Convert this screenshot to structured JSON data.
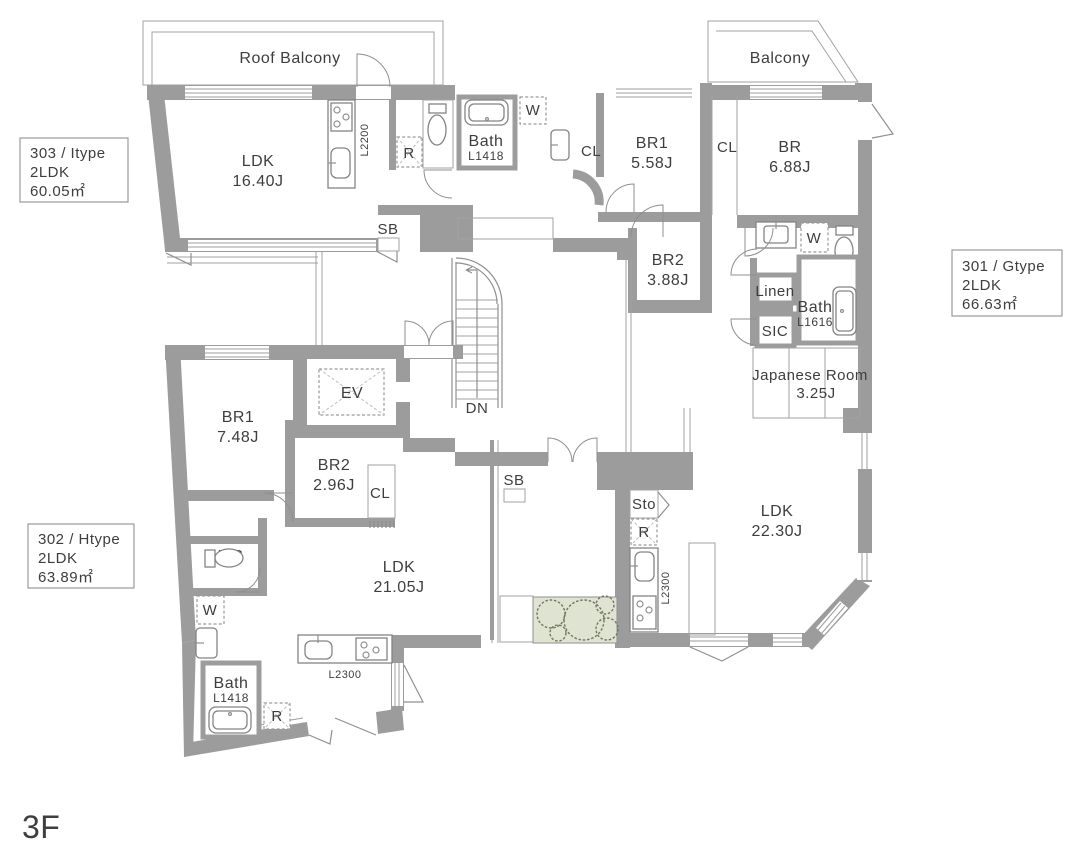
{
  "floor_label": "3F",
  "colors": {
    "wall": "#9c9c9c",
    "text": "#3e3e3e",
    "planter": "#dfe4d2"
  },
  "balconies": {
    "roof": "Roof Balcony",
    "main": "Balcony"
  },
  "core": {
    "elevator": "EV",
    "stairs_down": "DN"
  },
  "units": {
    "u303": {
      "name": "303 / Itype",
      "layout": "2LDK",
      "area": "60.05㎡",
      "labels": {
        "ldk": "LDK",
        "ldk_size": "16.40J",
        "kitchen_len": "L2200",
        "fridge": "R",
        "washer": "W",
        "bath": "Bath",
        "bath_size": "L1418",
        "closet": "CL",
        "br1": "BR1",
        "br1_size": "5.58J",
        "br2": "BR2",
        "br2_size": "3.88J",
        "shoebox": "SB"
      }
    },
    "u301": {
      "name": "301 / Gtype",
      "layout": "2LDK",
      "area": "66.63㎡",
      "labels": {
        "br": "BR",
        "br_size": "6.88J",
        "closet": "CL",
        "washer": "W",
        "linen": "Linen",
        "shoe_closet": "SIC",
        "bath": "Bath",
        "bath_size": "L1616",
        "jroom": "Japanese Room",
        "jroom_size": "3.25J",
        "ldk": "LDK",
        "ldk_size": "22.30J",
        "storage": "Sto",
        "fridge": "R",
        "kitchen_len": "L2300",
        "shoebox": "SB"
      }
    },
    "u302": {
      "name": "302 / Htype",
      "layout": "2LDK",
      "area": "63.89㎡",
      "labels": {
        "br1": "BR1",
        "br1_size": "7.48J",
        "br2": "BR2",
        "br2_size": "2.96J",
        "closet": "CL",
        "wic": "WIC",
        "washer": "W",
        "bath": "Bath",
        "bath_size": "L1418",
        "fridge": "R",
        "ldk": "LDK",
        "ldk_size": "21.05J",
        "kitchen_len": "L2300"
      }
    }
  }
}
